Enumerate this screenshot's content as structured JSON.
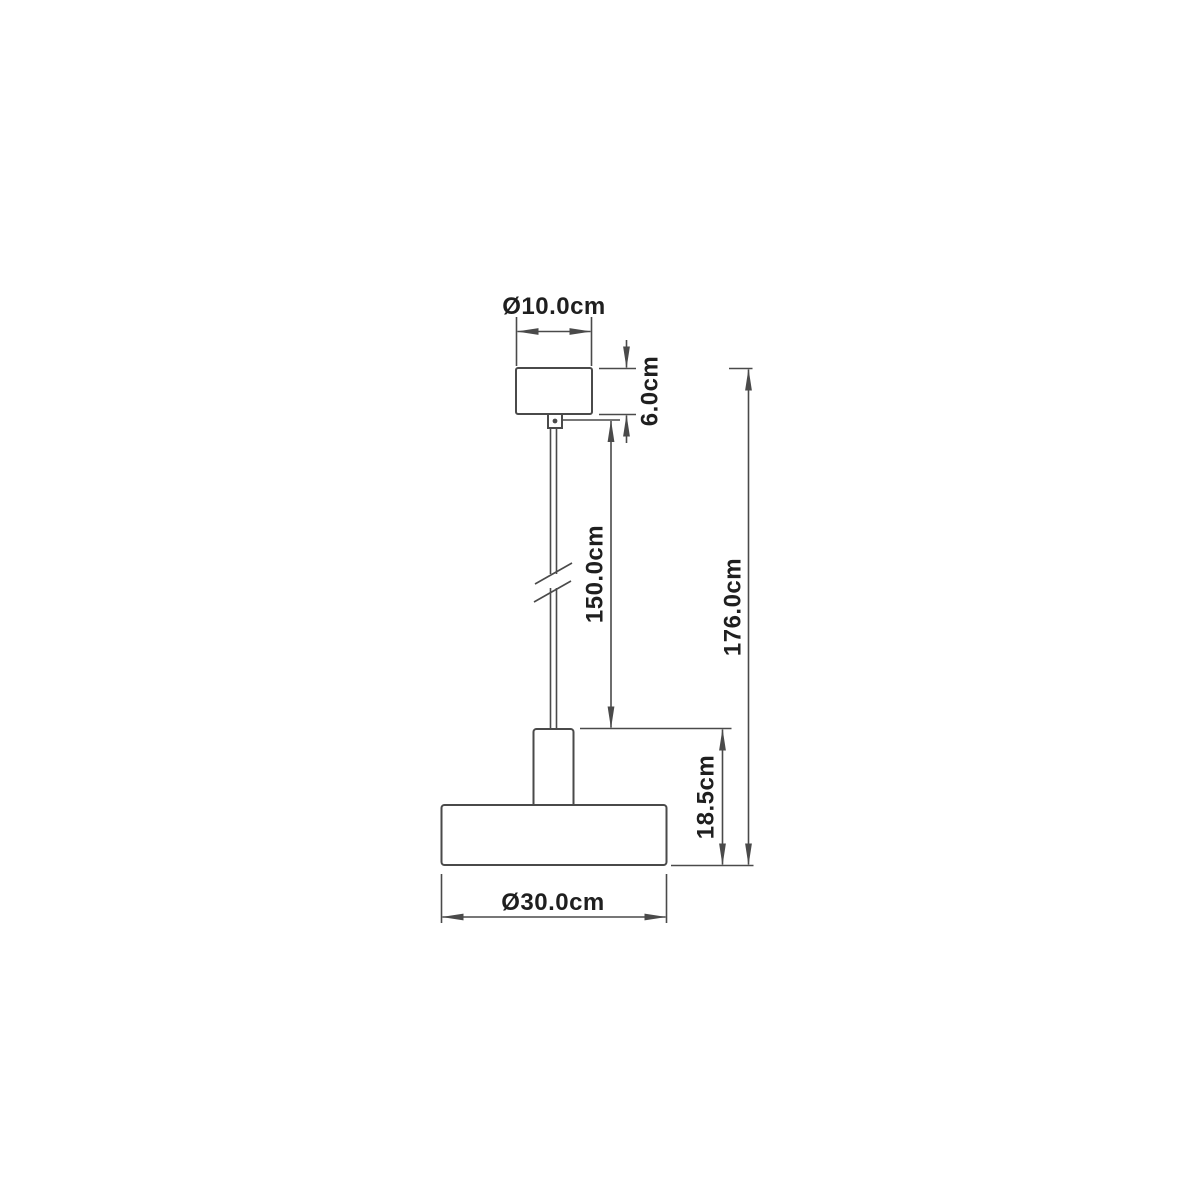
{
  "diagram": {
    "type": "technical-dimension-drawing",
    "subject": "pendant lamp",
    "labels": {
      "canopy_diameter": "Ø10.0cm",
      "canopy_height": "6.0cm",
      "cable_length": "150.0cm",
      "total_height": "176.0cm",
      "fixture_height": "18.5cm",
      "shade_diameter": "Ø30.0cm"
    },
    "colors": {
      "line": "#4a4a4a",
      "text": "#1f1f1f",
      "background": "#ffffff"
    }
  }
}
